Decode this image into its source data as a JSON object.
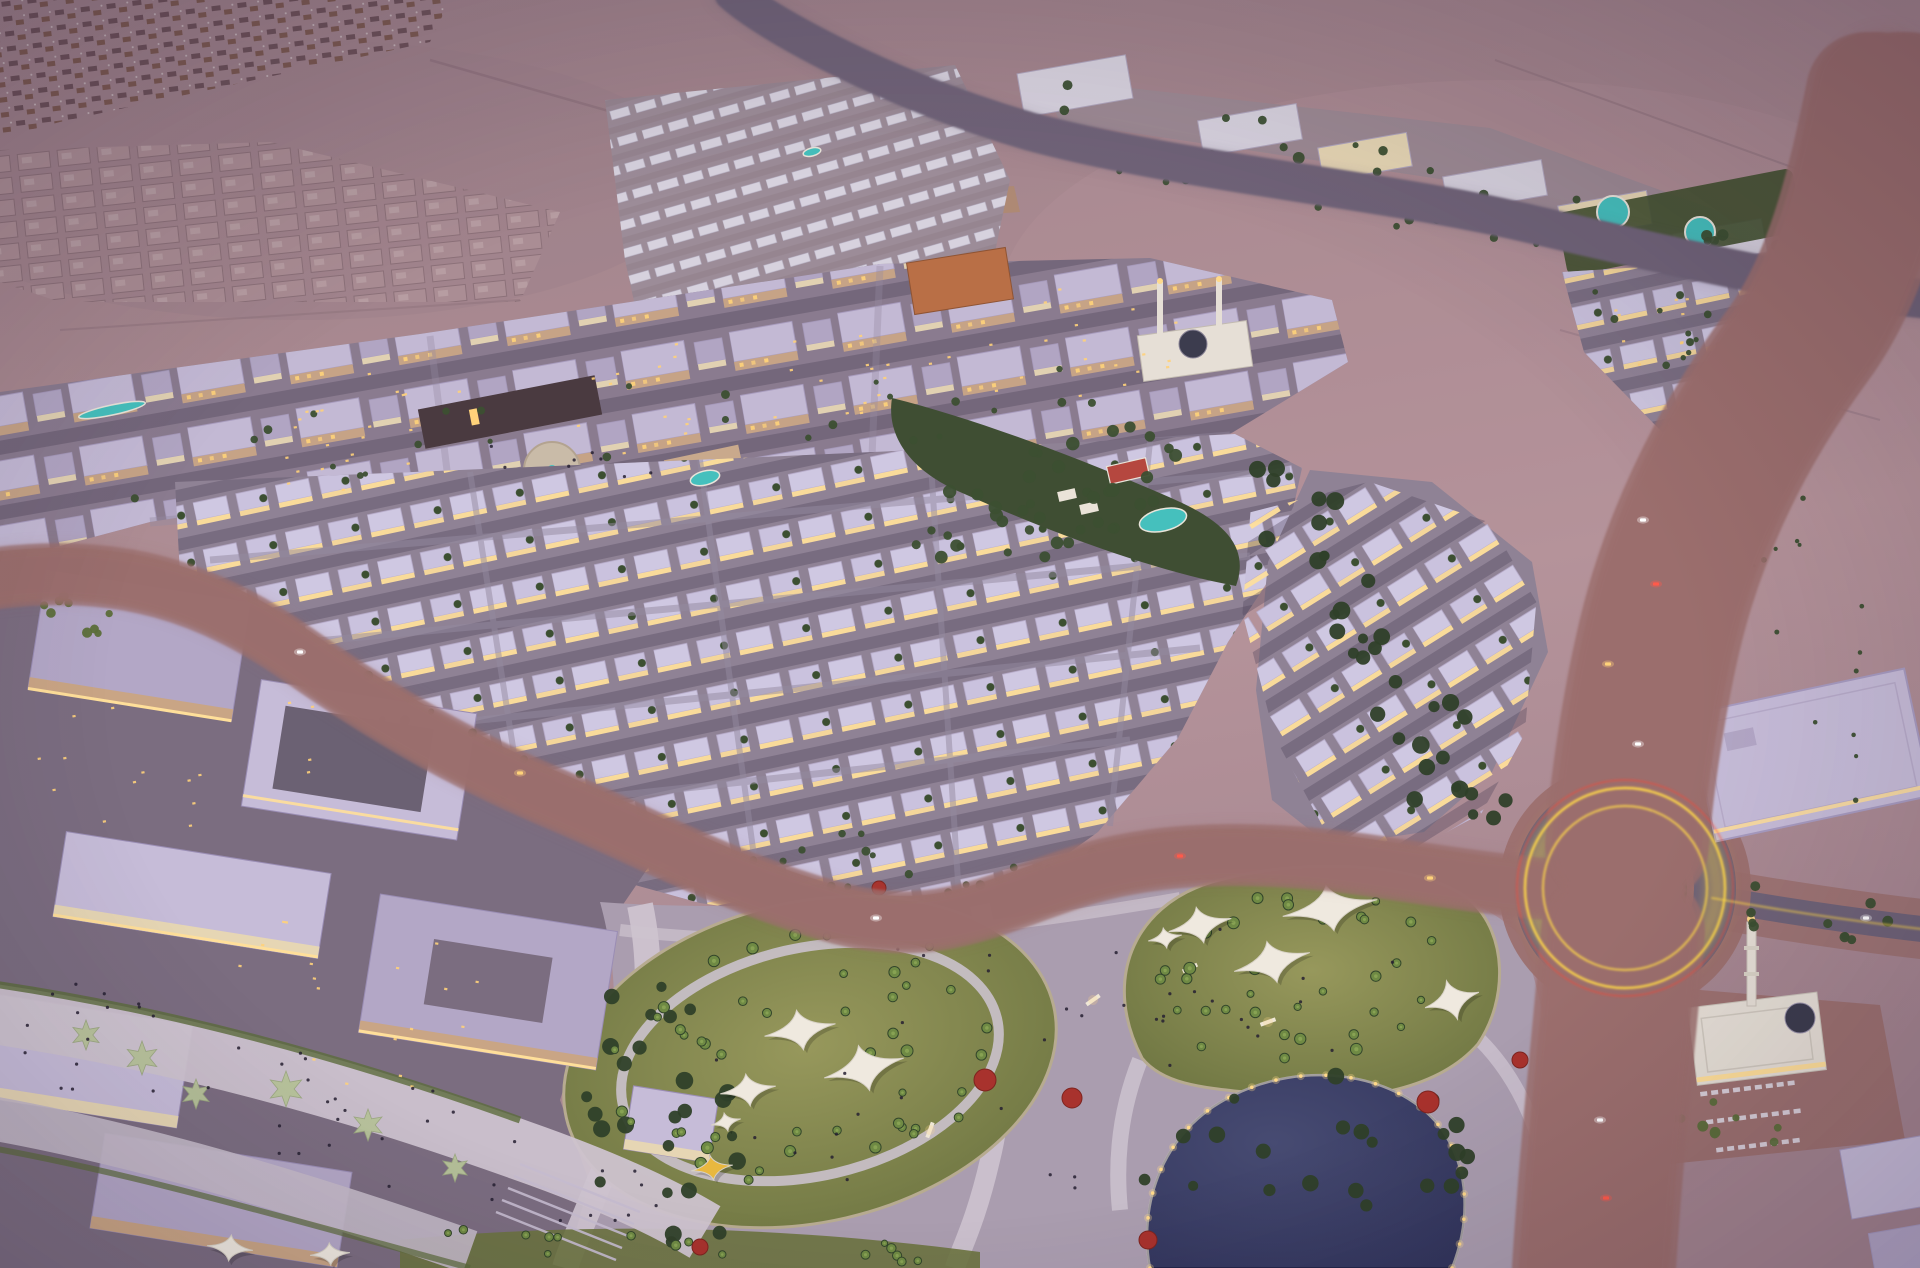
{
  "scene": {
    "title": "Aerial dusk rendering of a master-planned desert community",
    "description": "Bird's-eye architectural rendering at dusk: an illuminated villa and townhouse district with a town centre, two mosques, a landscaped park with shade sails and a lake, a lit boulevard with a star roundabout, long-exposure traffic light trails, and desert construction plots beyond.",
    "districts": [
      {
        "name": "distant-construction-site",
        "label": "Construction plots on horizon"
      },
      {
        "name": "unbuilt-villa-plots",
        "label": "Graded villa plots"
      },
      {
        "name": "north-villa-field",
        "label": "Unlit villa field with pool"
      },
      {
        "name": "highway-apartments",
        "label": "Apartment strip with round pools"
      },
      {
        "name": "town-centre",
        "label": "Mixed-use town centre with mosque"
      },
      {
        "name": "villa-district",
        "label": "Illuminated villa and townhouse rows"
      },
      {
        "name": "central-pocket-park",
        "label": "Linear park with pool and sports court"
      },
      {
        "name": "commercial-campus",
        "label": "Commercial campus and promenade"
      },
      {
        "name": "community-park",
        "label": "Community park with shade sails and lake"
      },
      {
        "name": "boulevard",
        "label": "Main boulevard with star roundabout"
      },
      {
        "name": "south-mosque",
        "label": "Mosque with minaret and plaza"
      }
    ]
  },
  "palette": {
    "desert_top": "#9b7f89",
    "desert_mid": "#aa8a91",
    "desert_low": "#a3848f",
    "desert_warm": "#b5939a",
    "ground_city": "#8a7b8f",
    "ground_commercial": "#7b6d80",
    "ground_park": "#aa9daf",
    "ground_plaza": "#b3a6b4",
    "brick": "#9b6f6d",
    "brick_dark": "#8a5f60",
    "road": "#6f6378",
    "road_light": "#948aa0",
    "lane_mark": "#cfc8d8",
    "median_green": "#4f5c38",
    "roof_lavender": "#c6bcd8",
    "roof_pale": "#d7d2de",
    "roof_deep": "#b3a7c6",
    "roof_dark": "#6b6173",
    "facade_tan": "#c9a585",
    "facade_cream": "#e6d6b4",
    "facade_orange": "#b96f46",
    "podium_dark": "#4a3a40",
    "window_glow": "#ffd27a",
    "lit_strip": "#ffdf9a",
    "trail_yellow": "#ffd84a",
    "trail_orange": "#ff9136",
    "trail_red": "#ff4632",
    "trail_core": "#fff3b8",
    "tree_dark": "#2f4029",
    "tree_mid": "#3c4f31",
    "tree_olive": "#5c6e3a",
    "palm_green": "#6f8a44",
    "lawn_light": "#97985c",
    "lawn_dark": "#6b7340",
    "canopy_base": "#3f4e33",
    "pool_teal": "#45c0bd",
    "lake_deep": "#30335a",
    "lake_mid": "#474b72",
    "sail_white": "#efe9df",
    "canopy_yellow": "#e9b83f",
    "planter_star": "#b8c49a",
    "mosque_white": "#e6dfd6",
    "dome_dark": "#3c3c4e",
    "tree_red": "#a8322d",
    "star_pool": "#2d3046",
    "people": "#262031",
    "shore_light": "#ffd98a",
    "court_red": "#b5473f",
    "construction_a": "#6d525a",
    "construction_b": "#7c5a52",
    "plot_line": "#8a6f77",
    "plot_fill": "#ab8e95",
    "pavement": "#cdc3cf",
    "sand_pad": "#b08a68"
  },
  "generate": {
    "vegetation": [
      {
        "name": "park-west-grove",
        "kind": "ellipse",
        "cx": 665,
        "cy": 1105,
        "rx": 85,
        "ry": 165,
        "rot": -8,
        "count": 26,
        "rmin": 5,
        "rmax": 9,
        "color": "tree_dark"
      },
      {
        "name": "left-lawn-palms",
        "kind": "ellipse",
        "cx": 810,
        "cy": 1062,
        "rx": 210,
        "ry": 128,
        "rot": -13,
        "count": 48,
        "rmin": 3.5,
        "rmax": 6,
        "color": "palm"
      },
      {
        "name": "right-lawn-palms",
        "kind": "ellipse",
        "cx": 1300,
        "cy": 972,
        "rx": 155,
        "ry": 92,
        "rot": -10,
        "count": 34,
        "rmin": 3.5,
        "rmax": 6,
        "color": "palm"
      },
      {
        "name": "central-park-trees",
        "kind": "ellipse",
        "cx": 1062,
        "cy": 495,
        "rx": 158,
        "ry": 56,
        "rot": -18,
        "count": 40,
        "rmin": 4,
        "rmax": 7,
        "color": "tree_mid"
      },
      {
        "name": "boulevard-belt",
        "kind": "band",
        "x1": 1268,
        "y1": 455,
        "x2": 1492,
        "y2": 855,
        "w": 44,
        "count": 36,
        "rmin": 5,
        "rmax": 9,
        "color": "tree_dark"
      },
      {
        "name": "highway-south-belt",
        "kind": "band",
        "x1": 1060,
        "y1": 150,
        "x2": 1700,
        "y2": 272,
        "w": 12,
        "count": 20,
        "rmin": 3,
        "rmax": 5,
        "color": "tree_mid"
      },
      {
        "name": "apartment-strip-gardens",
        "kind": "band",
        "x1": 1050,
        "y1": 100,
        "x2": 1790,
        "y2": 248,
        "w": 24,
        "count": 20,
        "rmin": 3,
        "rmax": 6,
        "color": "tree_mid"
      },
      {
        "name": "avenue-verge-west",
        "kind": "band",
        "x1": 240,
        "y1": 622,
        "x2": 560,
        "y2": 802,
        "w": 24,
        "count": 14,
        "rmin": 3,
        "rmax": 5,
        "color": "tree_mid"
      },
      {
        "name": "avenue-verge-park",
        "kind": "band",
        "x1": 620,
        "y1": 850,
        "x2": 1180,
        "y2": 872,
        "w": 28,
        "count": 20,
        "rmin": 3,
        "rmax": 5,
        "color": "tree_mid"
      },
      {
        "name": "pond-ring-trees",
        "kind": "ellipse",
        "cx": 1300,
        "cy": 1168,
        "rx": 172,
        "ry": 92,
        "rot": -6,
        "count": 22,
        "rmin": 5,
        "rmax": 9,
        "color": "tree_dark"
      },
      {
        "name": "roundabout-garden",
        "kind": "ellipse",
        "cx": 1625,
        "cy": 888,
        "rx": 44,
        "ry": 44,
        "rot": 0,
        "count": 9,
        "rmin": 4,
        "rmax": 6,
        "color": "tree_olive"
      },
      {
        "name": "blvd-median-north",
        "kind": "band",
        "x1": 1668,
        "y1": 440,
        "x2": 1630,
        "y2": 820,
        "w": 5,
        "count": 15,
        "rmin": 2.5,
        "rmax": 3.5,
        "color": "tree_olive"
      },
      {
        "name": "blvd-median-south",
        "kind": "band",
        "x1": 1618,
        "y1": 975,
        "x2": 1598,
        "y2": 1255,
        "w": 5,
        "count": 10,
        "rmin": 2.5,
        "rmax": 3.5,
        "color": "tree_olive"
      },
      {
        "name": "east-road-trees",
        "kind": "band",
        "x1": 1700,
        "y1": 900,
        "x2": 1905,
        "y2": 928,
        "w": 24,
        "count": 10,
        "rmin": 3.5,
        "rmax": 5.5,
        "color": "tree_mid"
      },
      {
        "name": "mosque-plaza-palms",
        "kind": "band",
        "x1": 1660,
        "y1": 1098,
        "x2": 1868,
        "y2": 1148,
        "w": 22,
        "count": 9,
        "rmin": 3.5,
        "rmax": 5.5,
        "color": "tree_olive"
      },
      {
        "name": "commercial-pocket-park",
        "kind": "ellipse",
        "cx": 80,
        "cy": 610,
        "rx": 42,
        "ry": 28,
        "rot": 0,
        "count": 9,
        "rmin": 3.5,
        "rmax": 5.5,
        "color": "tree_olive"
      },
      {
        "name": "city-courtyard-trees",
        "kind": "band",
        "x1": 130,
        "y1": 470,
        "x2": 1090,
        "y2": 380,
        "w": 44,
        "count": 26,
        "rmin": 2.5,
        "rmax": 4.5,
        "color": "tree_mid"
      },
      {
        "name": "bottom-lawn-palms",
        "kind": "band",
        "x1": 430,
        "y1": 1240,
        "x2": 950,
        "y2": 1252,
        "w": 12,
        "count": 16,
        "rmin": 3,
        "rmax": 5,
        "color": "palm"
      },
      {
        "name": "ne-villas-green",
        "kind": "band",
        "x1": 1585,
        "y1": 305,
        "x2": 1795,
        "y2": 378,
        "w": 36,
        "count": 10,
        "rmin": 2.5,
        "rmax": 4,
        "color": "tree_mid"
      },
      {
        "name": "desert-scrub",
        "kind": "band",
        "x1": 1750,
        "y1": 470,
        "x2": 1895,
        "y2": 810,
        "w": 60,
        "count": 16,
        "rmin": 1.5,
        "rmax": 3,
        "color": "tree_mid"
      }
    ],
    "red_trees": [
      {
        "cx": 985,
        "cy": 1080,
        "r": 11
      },
      {
        "cx": 1072,
        "cy": 1098,
        "r": 10
      },
      {
        "cx": 1148,
        "cy": 1240,
        "r": 9
      },
      {
        "cx": 1428,
        "cy": 1102,
        "r": 11
      },
      {
        "cx": 1520,
        "cy": 1060,
        "r": 8
      },
      {
        "cx": 700,
        "cy": 1247,
        "r": 8
      },
      {
        "cx": 879,
        "cy": 888,
        "r": 7
      }
    ],
    "people": [
      {
        "name": "promenade-crowd",
        "kind": "band",
        "x1": 20,
        "y1": 1020,
        "x2": 680,
        "y2": 1215,
        "w": 55,
        "count": 46
      },
      {
        "name": "park-visitors",
        "kind": "ellipse",
        "cx": 950,
        "cy": 1080,
        "rx": 255,
        "ry": 148,
        "rot": -10,
        "count": 26
      },
      {
        "name": "right-park-visitors",
        "kind": "ellipse",
        "cx": 1250,
        "cy": 990,
        "rx": 148,
        "ry": 88,
        "rot": -10,
        "count": 12
      },
      {
        "name": "plaza-people",
        "kind": "band",
        "x1": 480,
        "y1": 452,
        "x2": 700,
        "y2": 468,
        "w": 16,
        "count": 8
      }
    ],
    "window_glints": [
      {
        "kind": "ellipse",
        "cx": 320,
        "cy": 435,
        "rx": 158,
        "ry": 58,
        "rot": -10,
        "count": 22
      },
      {
        "kind": "ellipse",
        "cx": 720,
        "cy": 392,
        "rx": 178,
        "ry": 68,
        "rot": -10,
        "count": 26
      },
      {
        "kind": "ellipse",
        "cx": 1060,
        "cy": 345,
        "rx": 138,
        "ry": 58,
        "rot": -8,
        "count": 20
      },
      {
        "kind": "ellipse",
        "cx": 180,
        "cy": 760,
        "rx": 148,
        "ry": 88,
        "rot": -10,
        "count": 16
      },
      {
        "kind": "ellipse",
        "cx": 350,
        "cy": 1000,
        "rx": 218,
        "ry": 88,
        "rot": 9,
        "count": 18
      },
      {
        "kind": "ellipse",
        "cx": 1690,
        "cy": 330,
        "rx": 108,
        "ry": 48,
        "rot": -6,
        "count": 12
      }
    ],
    "sails": [
      {
        "cx": 800,
        "cy": 1030,
        "w": 72,
        "h": 40,
        "rot": -10,
        "color": "sail_white"
      },
      {
        "cx": 864,
        "cy": 1068,
        "w": 82,
        "h": 46,
        "rot": -14,
        "color": "sail_white"
      },
      {
        "cx": 748,
        "cy": 1090,
        "w": 56,
        "h": 32,
        "rot": -8,
        "color": "sail_white"
      },
      {
        "cx": 726,
        "cy": 1122,
        "w": 30,
        "h": 18,
        "rot": -12,
        "color": "sail_white"
      },
      {
        "cx": 712,
        "cy": 1168,
        "w": 42,
        "h": 24,
        "rot": -8,
        "color": "canopy_yellow"
      },
      {
        "cx": 1200,
        "cy": 925,
        "w": 64,
        "h": 36,
        "rot": -12,
        "color": "sail_white"
      },
      {
        "cx": 1330,
        "cy": 908,
        "w": 96,
        "h": 46,
        "rot": -10,
        "color": "sail_white"
      },
      {
        "cx": 1272,
        "cy": 962,
        "w": 78,
        "h": 42,
        "rot": -14,
        "color": "sail_white"
      },
      {
        "cx": 1452,
        "cy": 1000,
        "w": 56,
        "h": 40,
        "rot": -16,
        "color": "sail_white"
      },
      {
        "cx": 1165,
        "cy": 938,
        "w": 34,
        "h": 20,
        "rot": -10,
        "color": "sail_white"
      },
      {
        "cx": 230,
        "cy": 1248,
        "w": 46,
        "h": 26,
        "rot": 6,
        "color": "sail_white"
      },
      {
        "cx": 330,
        "cy": 1254,
        "w": 40,
        "h": 22,
        "rot": -4,
        "color": "sail_white"
      }
    ],
    "star_planters": [
      {
        "cx": 86,
        "cy": 1035,
        "r": 15
      },
      {
        "cx": 142,
        "cy": 1058,
        "r": 17
      },
      {
        "cx": 196,
        "cy": 1094,
        "r": 15
      },
      {
        "cx": 286,
        "cy": 1089,
        "r": 18
      },
      {
        "cx": 368,
        "cy": 1125,
        "r": 16
      },
      {
        "cx": 455,
        "cy": 1168,
        "r": 14
      }
    ],
    "pools": [
      {
        "cx": 1613,
        "cy": 212,
        "r": 16
      },
      {
        "cx": 1700,
        "cy": 232,
        "r": 15
      },
      {
        "cx": 1163,
        "cy": 520,
        "rx": 24,
        "ry": 11,
        "rot": -13
      },
      {
        "cx": 705,
        "cy": 478,
        "rx": 15,
        "ry": 7,
        "rot": -14
      },
      {
        "cx": 812,
        "cy": 152,
        "rx": 9,
        "ry": 4,
        "rot": -14
      },
      {
        "cx": 112,
        "cy": 410,
        "rx": 34,
        "ry": 5,
        "rot": -12
      }
    ],
    "benches": [
      {
        "x": 1093,
        "y": 1000,
        "rot": -35
      },
      {
        "x": 1268,
        "y": 1022,
        "rot": -20
      },
      {
        "x": 930,
        "y": 1130,
        "rot": -70
      },
      {
        "x": 1190,
        "y": 968,
        "rot": -25
      }
    ],
    "shore_lights": {
      "count": 24
    },
    "roundabout_star": {
      "points": 8,
      "r1": 40,
      "r2": 17,
      "cx": 1625,
      "cy": 888
    },
    "parking_rows": [
      {
        "x": 1700,
        "y": 1092,
        "cols": 9,
        "rot": -7
      },
      {
        "x": 1706,
        "y": 1120,
        "cols": 9,
        "rot": -7
      },
      {
        "x": 1716,
        "y": 1148,
        "cols": 8,
        "rot": -7
      }
    ],
    "cars": [
      {
        "x": 1643,
        "y": 520,
        "c": "#ffffff"
      },
      {
        "x": 1656,
        "y": 584,
        "c": "#ff5a4a"
      },
      {
        "x": 1608,
        "y": 664,
        "c": "#ffd27a"
      },
      {
        "x": 1638,
        "y": 744,
        "c": "#ffffff"
      },
      {
        "x": 300,
        "y": 652,
        "c": "#ffffff"
      },
      {
        "x": 520,
        "y": 773,
        "c": "#ffd27a"
      },
      {
        "x": 876,
        "y": 918,
        "c": "#ffffff"
      },
      {
        "x": 1180,
        "y": 856,
        "c": "#ff5a4a"
      },
      {
        "x": 1600,
        "y": 1120,
        "c": "#ffffff"
      },
      {
        "x": 1606,
        "y": 1198,
        "c": "#ff5a4a"
      },
      {
        "x": 1866,
        "y": 918,
        "c": "#ffffff"
      },
      {
        "x": 1430,
        "y": 878,
        "c": "#ffd27a"
      }
    ]
  }
}
